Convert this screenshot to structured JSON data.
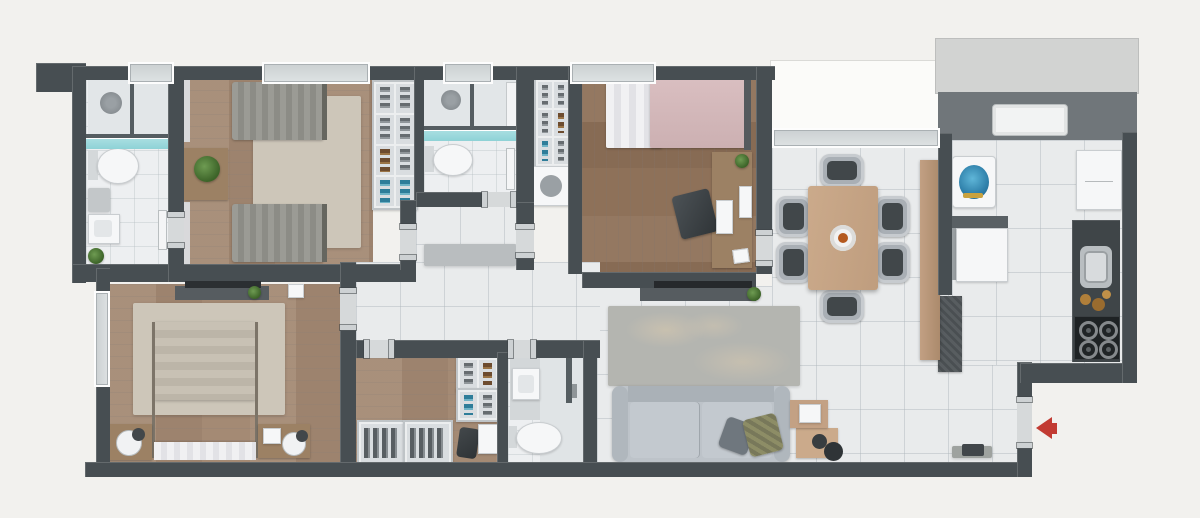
{
  "title": "apartment-floor-plan",
  "colors": {
    "bg": "#f2f1ee",
    "wall": "#474e52",
    "jamb": "#cdd1d3",
    "tile": "#e9ebec",
    "bath_floor": "#edeff1",
    "wood": "#a48a74",
    "wood_dark": "#8e7159",
    "wood_furn": "#9c8164",
    "rug_beige": "#cdc6b9",
    "rug_gray": "#b4b5b0",
    "linen": "#f3f3f5",
    "blanket_gray": "#98978f",
    "blanket_pink": "#d9bec0",
    "sofa": "#bdc3c9",
    "chair": "#a9afb5",
    "seat_dark": "#41474a",
    "table_wood": "#cbaa8b",
    "sideboard_wood": "#c2a083",
    "counter_dark": "#3f4548",
    "teal_glass": "#8ed2d6",
    "plant_green": "#4f7e3c",
    "arrow_red": "#c23b33",
    "balcony_slab": "#d2d3d2",
    "service_band": "#70767a",
    "washer_blue": "#2e7fa9",
    "olive": "#8d8d66"
  },
  "rooms": {
    "bathroom1": "bathroom-1",
    "bedroom1": "bedroom-1",
    "corridor": "corridor",
    "bathroom2": "bathroom-2",
    "bedroom2": "bedroom-2",
    "hall": "hall",
    "master": "master-bedroom",
    "closet": "walk-in-closet",
    "bathroom3": "bathroom-3",
    "living": "living-room",
    "dining": "dining-room",
    "kitchen": "kitchen",
    "balcony": "balcony",
    "service": "service-area",
    "entry": "entry"
  },
  "indicators": {
    "entry_arrow_direction": "left"
  }
}
